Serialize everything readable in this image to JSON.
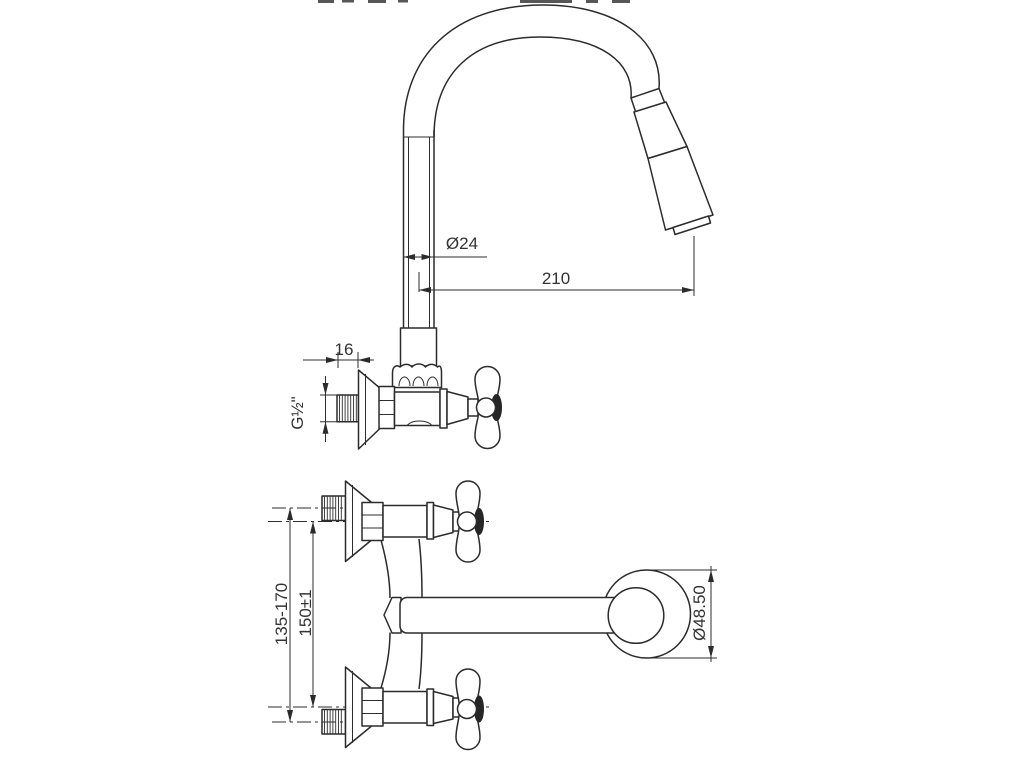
{
  "document": {
    "type": "technical-drawing",
    "background": "#ffffff",
    "line_color": "#2b2b2b",
    "text_color": "#333333"
  },
  "views": {
    "side": {
      "name": "side-view",
      "dims": {
        "pipe_diameter": "Ø24",
        "reach": "210",
        "nipple_length": "16",
        "thread": "G½\""
      }
    },
    "front": {
      "name": "front-view",
      "dims": {
        "wall_centers": "135-170",
        "valve_centers": "150±1",
        "flange_diameter": "Ø48.50"
      }
    }
  }
}
